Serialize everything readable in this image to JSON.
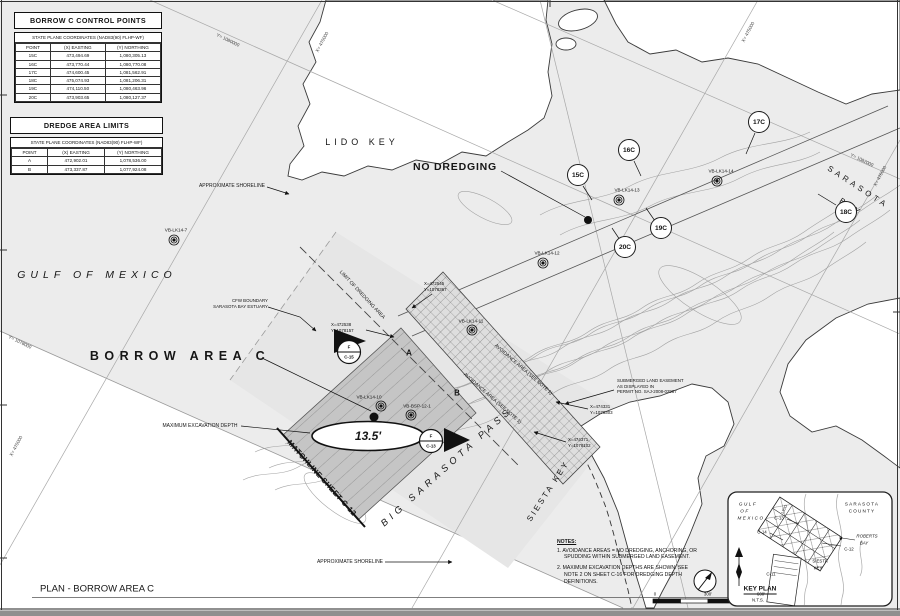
{
  "sheet": {
    "plan_title": "PLAN - BORROW AREA C"
  },
  "tables": {
    "control_points": {
      "title": "BORROW C CONTROL POINTS",
      "subtitle": "STATE PLANE COORDINATES (NAD83(90) FLHP-WF)",
      "columns": [
        "POINT",
        "(X) EASTING",
        "(Y) NORTHING"
      ],
      "rows": [
        [
          "15C",
          "473,494.69",
          "1,080,305.13"
        ],
        [
          "16C",
          "473,770.44",
          "1,080,770.08"
        ],
        [
          "17C",
          "474,600.45",
          "1,081,562.91"
        ],
        [
          "18C",
          "475,074.93",
          "1,081,206.31"
        ],
        [
          "19C",
          "474,110.50",
          "1,080,463.96"
        ],
        [
          "20C",
          "473,903.65",
          "1,080,127.37"
        ]
      ]
    },
    "dredge_limits": {
      "title": "DREDGE AREA LIMITS",
      "subtitle": "STATE PLANE COORDINATES (NAD83(90) FLHP-WF)",
      "columns": [
        "POINT",
        "(X) EASTING",
        "(Y) NORTHING"
      ],
      "rows": [
        [
          "A",
          "472,902.01",
          "1,078,536.00"
        ],
        [
          "B",
          "473,337.87",
          "1,077,924.08"
        ]
      ]
    }
  },
  "geo_labels": {
    "lido_key": "LIDO KEY",
    "gulf_of_mexico": "GULF OF MEXICO",
    "sarasota": "SARASOTA",
    "bay": "BAY",
    "big_sarasota_pass": "BIG SARASOTA PASS",
    "siesta_key": "SIESTA KEY"
  },
  "annotations": {
    "no_dredging": "NO DREDGING",
    "borrow_area_c": "BORROW AREA C",
    "maximum_excavation_depth": "MAXIMUM EXCAVATION DEPTH",
    "depth_value": "13.5'",
    "matchline": "MATCHLINE SHEET C-12",
    "limit_of_dredging_area": "LIMIT OF DREDGING AREA",
    "avoidance_area": "AVOIDANCE AREA (SEE NOTE 1)",
    "approximate_shoreline": "APPROXIMATE SHORELINE",
    "cfw_boundary_1": "CFW BOUNDARY",
    "cfw_boundary_2": "SARASOTA BAY ESTUARY",
    "easement_1": "SUBMERGED LAND EASEMENT",
    "easement_2": "AS DISPLAYED IN",
    "easement_3": "PERMIT NO. SAJ-2008-02987",
    "point_a": "A",
    "point_b": "B",
    "flag_f": "F",
    "flag_c15": "C-15",
    "flag_c13": "C-13"
  },
  "coordinate_callouts": [
    {
      "x": "X=472545",
      "y": "Y=1078367"
    },
    {
      "x": "X=472538",
      "y": "Y=1078157"
    },
    {
      "x": "X=474331",
      "y": "Y=1078303"
    },
    {
      "x": "X=474371",
      "y": "Y=1078102"
    }
  ],
  "grid_labels": {
    "y_1080000": "Y= 1080000",
    "x_470000_top": "X= 470000",
    "x_475000": "X= 475000",
    "y_1082000": "Y= 1082000",
    "x_476000": "X= 476000",
    "y_1078000": "Y= 1078000",
    "x_470000_bottom": "X= 470000"
  },
  "control_point_circles": [
    "15C",
    "16C",
    "17C",
    "18C",
    "19C",
    "20C"
  ],
  "vibracore_markers": [
    "VB-LK14-7",
    "VB-LK14-12",
    "VB-LK14-13",
    "VB-LK14-14",
    "VB-LK14-11",
    "VB-LK14-10",
    "VB-BSP-12-1"
  ],
  "notes": {
    "heading": "NOTES:",
    "note1_line1": "1. AVOIDANCE AREAS = NO DREDGING, ANCHORING, OR",
    "note1_line2": "SPUDDING WITHIN SUBMERGED LAND EASEMENT.",
    "note2_line1": "2. MAXIMUM EXCAVATION DEPTHS ARE SHOWN. SEE",
    "note2_line2": "NOTE 2 ON SHEET C-16 FOR DREDGING DEPTH",
    "note2_line3": "DEFINITIONS."
  },
  "scale_bar": {
    "start": "0",
    "mid": "300'",
    "end": "600'"
  },
  "key_plan": {
    "gulf_1": "GULF",
    "gulf_2": "OF",
    "gulf_3": "MEXICO",
    "county_1": "SARASOTA",
    "county_2": "COUNTY",
    "lido": "LIDO",
    "sheet_c13": "C-13",
    "sheet_c14": "C-14",
    "sheet_c12": "C-12",
    "sheet_c11": "C-11",
    "roberts_1": "ROBERTS",
    "roberts_2": "BAY",
    "siesta_1": "SIESTA",
    "siesta_2": "KEY",
    "title": "KEY PLAN",
    "scale_note": "N.T.S."
  }
}
